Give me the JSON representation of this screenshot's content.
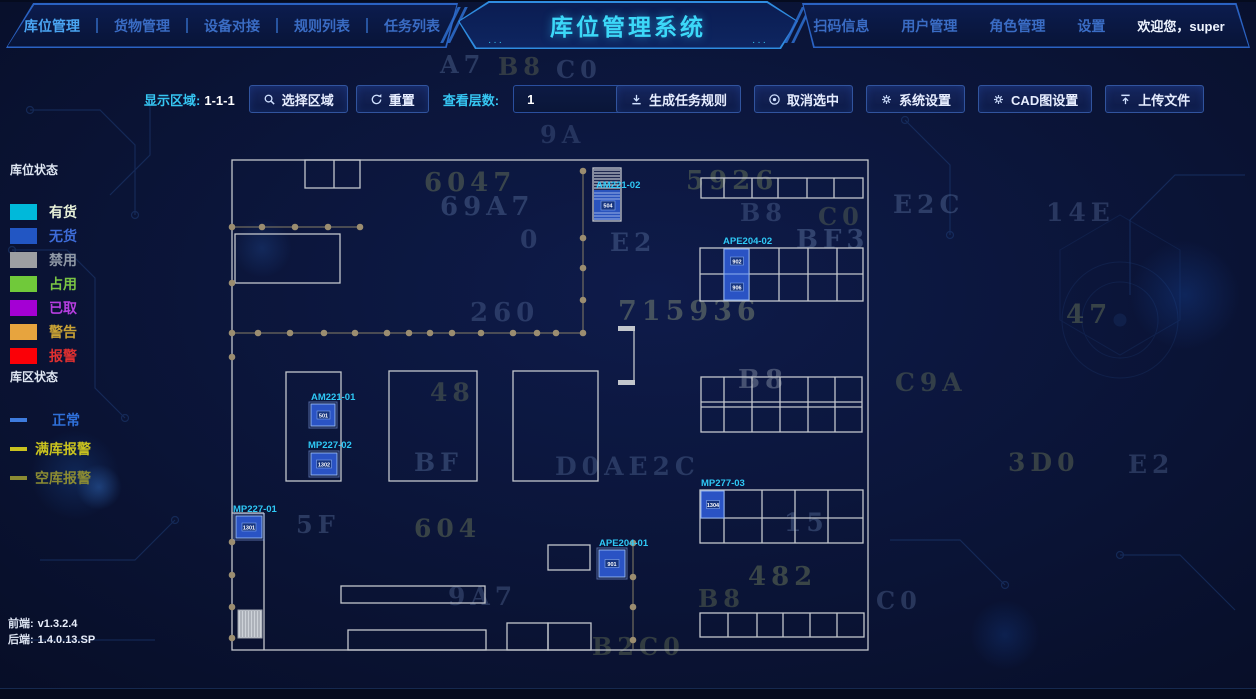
{
  "header": {
    "nav_left": [
      {
        "label": "库位管理",
        "active": true
      },
      {
        "label": "货物管理",
        "active": false
      },
      {
        "label": "设备对接",
        "active": false
      },
      {
        "label": "规则列表",
        "active": false
      },
      {
        "label": "任务列表",
        "active": false
      }
    ],
    "title": "库位管理系统",
    "nav_right": [
      {
        "label": "扫码信息"
      },
      {
        "label": "用户管理"
      },
      {
        "label": "角色管理"
      },
      {
        "label": "设置"
      }
    ],
    "welcome": "欢迎您，super",
    "accent_color": "#3cd8f8"
  },
  "toolbar": {
    "display_area_label": "显示区域:",
    "display_area_value": "1-1-1",
    "buttons_left": [
      {
        "icon": "search-icon",
        "label": "选择区域"
      },
      {
        "icon": "refresh-icon",
        "label": "重置"
      }
    ],
    "layer_label": "查看层数:",
    "layer_value": "1",
    "buttons_right": [
      {
        "icon": "download-icon",
        "label": "生成任务规则"
      },
      {
        "icon": "cancel-icon",
        "label": "取消选中"
      },
      {
        "icon": "gear-icon",
        "label": "系统设置"
      },
      {
        "icon": "gear-icon",
        "label": "CAD图设置"
      },
      {
        "icon": "upload-icon",
        "label": "上传文件"
      }
    ]
  },
  "legend": {
    "slot_title": "库位状态",
    "slot_items": [
      {
        "label": "有货",
        "color": "#00b9da",
        "label_color": "#e9f2d9"
      },
      {
        "label": "无货",
        "color": "#2256c3",
        "label_color": "#3e6cd8"
      },
      {
        "label": "禁用",
        "color": "#9d9fa2",
        "label_color": "#9099a6"
      },
      {
        "label": "占用",
        "color": "#70c93a",
        "label_color": "#7ac544"
      },
      {
        "label": "已取",
        "color": "#a400d4",
        "label_color": "#b63ee0"
      },
      {
        "label": "警告",
        "color": "#e7a43e",
        "label_color": "#c9a235"
      },
      {
        "label": "报警",
        "color": "#fb0007",
        "label_color": "#e03030"
      }
    ],
    "zone_title": "库区状态",
    "zone_items": [
      {
        "label": "正常",
        "color": "#3e7bdd",
        "label_color": "#2f6fd8"
      },
      {
        "label": "满库报警",
        "color": "#c9c21f",
        "label_color": "#c9c21f"
      },
      {
        "label": "空库报警",
        "color": "#8b8b33",
        "label_color": "#8b8b33"
      }
    ]
  },
  "versions": {
    "frontend_label": "前端:",
    "frontend_value": "v1.3.2.4",
    "backend_label": "后端:",
    "backend_value": "1.4.0.13.SP"
  },
  "map": {
    "labels": [
      {
        "id": "am221-02",
        "text": "AM221-02"
      },
      {
        "id": "ape204-02",
        "text": "APE204-02"
      },
      {
        "id": "am221-01",
        "text": "AM221-01"
      },
      {
        "id": "mp227-02",
        "text": "MP227-02"
      },
      {
        "id": "mp227-01",
        "text": "MP227-01"
      },
      {
        "id": "ape204-01",
        "text": "APE204-01"
      },
      {
        "id": "mp277-03",
        "text": "MP277-03"
      }
    ],
    "cells": [
      {
        "id": "am221-02-cell",
        "value": "504"
      },
      {
        "id": "ape204-02-cell-1",
        "value": "902"
      },
      {
        "id": "ape204-02-cell-2",
        "value": "906"
      },
      {
        "id": "am221-01-cell",
        "value": "501"
      },
      {
        "id": "mp227-02-cell",
        "value": "1302"
      },
      {
        "id": "mp227-01-cell",
        "value": "1301"
      },
      {
        "id": "ape204-01-cell",
        "value": "901"
      },
      {
        "id": "mp277-03-cell",
        "value": "1304"
      }
    ]
  },
  "background_glyphs": [
    {
      "text": "A7",
      "x": 440,
      "y": 50,
      "size": 24,
      "color": "rgba(96,120,165,0.38)"
    },
    {
      "text": "B8",
      "x": 498,
      "y": 52,
      "size": 24,
      "color": "rgba(120,130,90,0.35)"
    },
    {
      "text": "C0",
      "x": 556,
      "y": 55,
      "size": 24,
      "color": "rgba(96,120,165,0.35)"
    },
    {
      "text": "9A",
      "x": 540,
      "y": 120,
      "size": 24,
      "color": "rgba(96,120,165,0.30)"
    },
    {
      "text": "6047",
      "x": 424,
      "y": 168,
      "size": 26,
      "color": "rgba(125,138,92,0.40)"
    },
    {
      "text": "5926",
      "x": 686,
      "y": 166,
      "size": 26,
      "color": "rgba(125,138,92,0.42)"
    },
    {
      "text": "69A7",
      "x": 440,
      "y": 192,
      "size": 26,
      "color": "rgba(96,120,165,0.40)"
    },
    {
      "text": "B8",
      "x": 740,
      "y": 198,
      "size": 24,
      "color": "rgba(96,120,165,0.35)"
    },
    {
      "text": "C0",
      "x": 818,
      "y": 202,
      "size": 24,
      "color": "rgba(125,138,92,0.32)"
    },
    {
      "text": "E2C",
      "x": 893,
      "y": 190,
      "size": 25,
      "color": "rgba(96,120,165,0.40)"
    },
    {
      "text": "14E",
      "x": 1046,
      "y": 198,
      "size": 25,
      "color": "rgba(96,120,165,0.35)"
    },
    {
      "text": "0",
      "x": 520,
      "y": 225,
      "size": 25,
      "color": "rgba(96,120,165,0.35)"
    },
    {
      "text": "E2",
      "x": 610,
      "y": 228,
      "size": 25,
      "color": "rgba(96,120,165,0.40)"
    },
    {
      "text": "BF3",
      "x": 796,
      "y": 225,
      "size": 26,
      "color": "rgba(96,120,165,0.45)"
    },
    {
      "text": "260",
      "x": 470,
      "y": 298,
      "size": 26,
      "color": "rgba(96,120,165,0.35)"
    },
    {
      "text": "715936",
      "x": 618,
      "y": 296,
      "size": 27,
      "color": "rgba(140,150,120,0.45)"
    },
    {
      "text": "47",
      "x": 1066,
      "y": 300,
      "size": 26,
      "color": "rgba(125,138,92,0.40)"
    },
    {
      "text": "48",
      "x": 430,
      "y": 378,
      "size": 25,
      "color": "rgba(125,138,92,0.35)"
    },
    {
      "text": "B8",
      "x": 738,
      "y": 365,
      "size": 26,
      "color": "rgba(140,150,170,0.45)"
    },
    {
      "text": "C9A",
      "x": 895,
      "y": 368,
      "size": 25,
      "color": "rgba(125,138,92,0.35)"
    },
    {
      "text": "BF",
      "x": 414,
      "y": 448,
      "size": 25,
      "color": "rgba(96,120,165,0.40)"
    },
    {
      "text": "D0AE2C",
      "x": 555,
      "y": 452,
      "size": 25,
      "color": "rgba(96,120,165,0.35)"
    },
    {
      "text": "3D0",
      "x": 1008,
      "y": 448,
      "size": 25,
      "color": "rgba(125,138,92,0.38)"
    },
    {
      "text": "E2",
      "x": 1128,
      "y": 450,
      "size": 25,
      "color": "rgba(96,120,165,0.35)"
    },
    {
      "text": "5F",
      "x": 296,
      "y": 510,
      "size": 24,
      "color": "rgba(96,120,165,0.38)"
    },
    {
      "text": "604",
      "x": 414,
      "y": 514,
      "size": 25,
      "color": "rgba(125,138,92,0.40)"
    },
    {
      "text": "15",
      "x": 784,
      "y": 508,
      "size": 25,
      "color": "rgba(96,120,165,0.40)"
    },
    {
      "text": "482",
      "x": 748,
      "y": 562,
      "size": 26,
      "color": "rgba(125,138,92,0.42)"
    },
    {
      "text": "9A7",
      "x": 448,
      "y": 582,
      "size": 25,
      "color": "rgba(96,120,165,0.35)"
    },
    {
      "text": "B8",
      "x": 698,
      "y": 584,
      "size": 24,
      "color": "rgba(125,138,92,0.35)"
    },
    {
      "text": "C0",
      "x": 876,
      "y": 586,
      "size": 24,
      "color": "rgba(96,120,165,0.35)"
    },
    {
      "text": "B2C0",
      "x": 592,
      "y": 632,
      "size": 24,
      "color": "rgba(125,138,92,0.35)"
    }
  ]
}
